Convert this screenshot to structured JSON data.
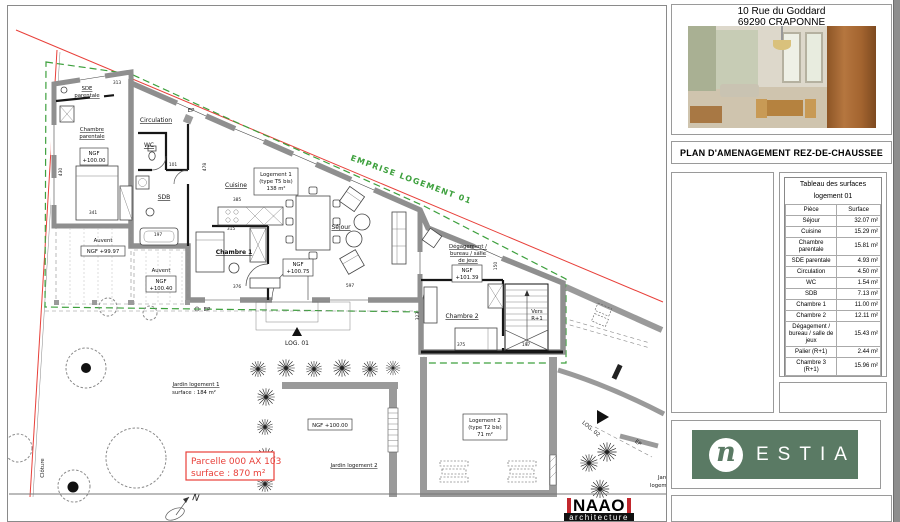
{
  "colors": {
    "emprise_green": "#3da03d",
    "boundary_red": "#e8403a",
    "wall_gray": "#8f8f8f",
    "nestia_green": "#5a7a64",
    "naao_red": "#c1272d"
  },
  "plan": {
    "labels": {
      "emprise": "EMPRISE LOGEMENT 01",
      "sde": [
        "SDE",
        "parentale"
      ],
      "chambre_parentale": [
        "Chambre",
        "parentale"
      ],
      "ngf_parentale": [
        "NGF",
        "+100.00"
      ],
      "circulation": "Circulation",
      "wc": "WC",
      "sdb": "SDB",
      "cuisine": "Cuisine",
      "log1": [
        "Logement 1",
        "(type T5 bis)",
        "138 m²"
      ],
      "sejour": "Séjour",
      "chambre1": "Chambre 1",
      "ngf_sejour": [
        "NGF",
        "+100.75"
      ],
      "degagement": [
        "Dégagement /",
        "bureau / salle",
        "de jeux"
      ],
      "ngf_degagement": [
        "NGF",
        "+101.39"
      ],
      "chambre2": "Chambre 2",
      "vers_r1": [
        "Vers",
        "R+1"
      ],
      "auvent_left": "Auvent",
      "ngf_auvent_left": "NGF +99.97",
      "auvent_right": "Auvent",
      "ngf_auvent_right": [
        "NGF",
        "+100.40"
      ],
      "jardin1": [
        "Jardin logement 1",
        "surface : 184 m²"
      ],
      "ngf_jardin": "NGF +100.00",
      "jardin2": "Jardin logement 2",
      "log2": [
        "Logement 2",
        "(type T2 bis)",
        "71 m²"
      ],
      "log01": "LOG. 01",
      "log02": "LOG. 02",
      "ep1": "EP",
      "ep2": "EP",
      "ep3": "EP",
      "cloture": "Clôture",
      "parcelle": [
        "Parcelle 000 AX 103",
        "surface : 870 m²"
      ],
      "jardin2_clipped": [
        "Jardin",
        "logement 2"
      ],
      "north": "N"
    },
    "dimensions": [
      {
        "t": "313",
        "x": 117,
        "y": 84,
        "r": 0
      },
      {
        "t": "430",
        "x": 62,
        "y": 172,
        "r": -90
      },
      {
        "t": "341",
        "x": 93,
        "y": 214,
        "r": 0
      },
      {
        "t": "101",
        "x": 173,
        "y": 166,
        "r": 0
      },
      {
        "t": "478",
        "x": 206,
        "y": 167,
        "r": -90
      },
      {
        "t": "385",
        "x": 237,
        "y": 201,
        "r": 0
      },
      {
        "t": "315",
        "x": 231,
        "y": 230,
        "r": 0
      },
      {
        "t": "197",
        "x": 158,
        "y": 236,
        "r": 0
      },
      {
        "t": "376",
        "x": 237,
        "y": 288,
        "r": 0
      },
      {
        "t": "597",
        "x": 350,
        "y": 287,
        "r": 0
      },
      {
        "t": "150",
        "x": 497,
        "y": 266,
        "r": -90
      },
      {
        "t": "323",
        "x": 419,
        "y": 316,
        "r": -90
      },
      {
        "t": "375",
        "x": 461,
        "y": 346,
        "r": 0
      },
      {
        "t": "197",
        "x": 526,
        "y": 346,
        "r": 0
      }
    ]
  },
  "sidebar": {
    "address": [
      "10 Rue du Goddard",
      "69290 CRAPONNE"
    ],
    "plan_title": "PLAN D'AMENAGEMENT REZ-DE-CHAUSSEE",
    "surface_table": {
      "title": [
        "Tableau des surfaces",
        "logement 01"
      ],
      "columns": [
        "Pièce",
        "Surface"
      ],
      "rows": [
        {
          "piece": "Séjour",
          "surface": "32.07 m²"
        },
        {
          "piece": "Cuisine",
          "surface": "15.29 m²"
        },
        {
          "piece": "Chambre parentale",
          "surface": "15.81 m²"
        },
        {
          "piece": "SDE parentale",
          "surface": "4.93 m²"
        },
        {
          "piece": "Circulation",
          "surface": "4.50 m²"
        },
        {
          "piece": "WC",
          "surface": "1.54 m²"
        },
        {
          "piece": "SDB",
          "surface": "7.13 m²"
        },
        {
          "piece": "Chambre 1",
          "surface": "11.00 m²"
        },
        {
          "piece": "Chambre 2",
          "surface": "12.11 m²"
        },
        {
          "piece": "Dégagement / bureau / salle de jeux",
          "surface": "15.43 m²"
        },
        {
          "piece": "Palier (R+1)",
          "surface": "2.44 m²"
        },
        {
          "piece": "Chambre 3 (R+1)",
          "surface": "15.96 m²"
        }
      ],
      "total": "138.22 m²"
    },
    "nestia": {
      "n": "n",
      "letters": "ESTIA"
    }
  },
  "titleblock": {
    "naao": "NAAO",
    "naao_sub": "architecture"
  }
}
